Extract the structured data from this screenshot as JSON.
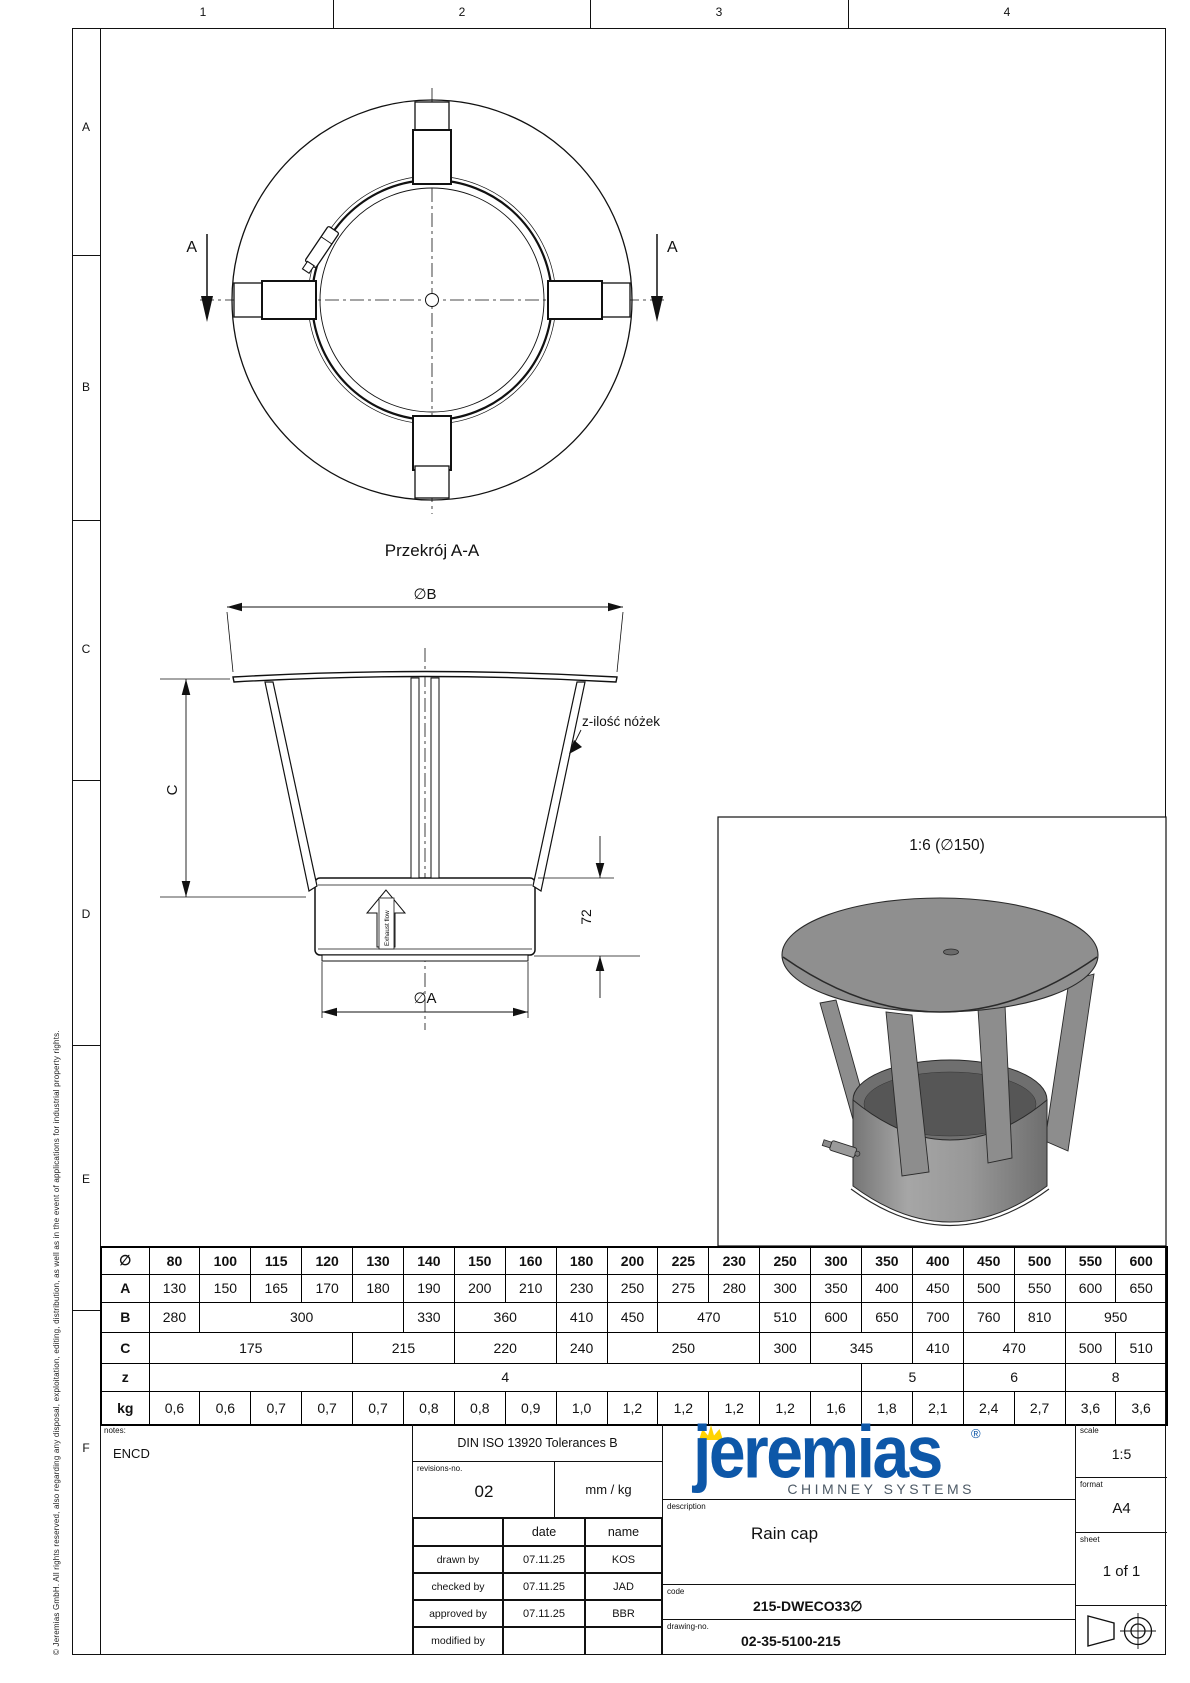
{
  "rulers": {
    "top": [
      "1",
      "2",
      "3",
      "4"
    ],
    "left": [
      "A",
      "B",
      "C",
      "D",
      "E",
      "F"
    ]
  },
  "copyright": "© Jeremias GmbH. All rights reserved, also regarding any disposal, exploitation, editing, distribution, as well as in the event of applications for industrial property rights.",
  "views": {
    "section_label": "Przekrój A-A",
    "marker": "A",
    "dim_b": "∅B",
    "dim_a": "∅A",
    "dim_c": "C",
    "dim_72": "72",
    "legs_label": "z-ilość nóżek",
    "exhaust": "Exhaust flow",
    "detail_label": "1:6 (∅150)"
  },
  "table": {
    "corner": "∅",
    "sizes": [
      "80",
      "100",
      "115",
      "120",
      "130",
      "140",
      "150",
      "160",
      "180",
      "200",
      "225",
      "230",
      "250",
      "300",
      "350",
      "400",
      "450",
      "500",
      "550",
      "600"
    ],
    "rows": [
      {
        "label": "A",
        "cells": [
          [
            "130",
            1
          ],
          [
            "150",
            1
          ],
          [
            "165",
            1
          ],
          [
            "170",
            1
          ],
          [
            "180",
            1
          ],
          [
            "190",
            1
          ],
          [
            "200",
            1
          ],
          [
            "210",
            1
          ],
          [
            "230",
            1
          ],
          [
            "250",
            1
          ],
          [
            "275",
            1
          ],
          [
            "280",
            1
          ],
          [
            "300",
            1
          ],
          [
            "350",
            1
          ],
          [
            "400",
            1
          ],
          [
            "450",
            1
          ],
          [
            "500",
            1
          ],
          [
            "550",
            1
          ],
          [
            "600",
            1
          ],
          [
            "650",
            1
          ]
        ]
      },
      {
        "label": "B",
        "cells": [
          [
            "280",
            1
          ],
          [
            "300",
            4
          ],
          [
            "330",
            1
          ],
          [
            "360",
            2
          ],
          [
            "410",
            1
          ],
          [
            "450",
            1
          ],
          [
            "470",
            2
          ],
          [
            "510",
            1
          ],
          [
            "600",
            1
          ],
          [
            "650",
            1
          ],
          [
            "700",
            1
          ],
          [
            "760",
            1
          ],
          [
            "810",
            1
          ],
          [
            "950",
            2
          ]
        ]
      },
      {
        "label": "C",
        "cells": [
          [
            "175",
            4
          ],
          [
            "215",
            2
          ],
          [
            "220",
            2
          ],
          [
            "240",
            1
          ],
          [
            "250",
            3
          ],
          [
            "300",
            1
          ],
          [
            "345",
            2
          ],
          [
            "410",
            1
          ],
          [
            "470",
            2
          ],
          [
            "500",
            1
          ],
          [
            "510",
            1
          ]
        ]
      },
      {
        "label": "z",
        "cells": [
          [
            "4",
            14
          ],
          [
            "5",
            2
          ],
          [
            "6",
            2
          ],
          [
            "8",
            2
          ]
        ]
      },
      {
        "label": "kg",
        "cells": [
          [
            "0,6",
            1
          ],
          [
            "0,6",
            1
          ],
          [
            "0,7",
            1
          ],
          [
            "0,7",
            1
          ],
          [
            "0,7",
            1
          ],
          [
            "0,8",
            1
          ],
          [
            "0,8",
            1
          ],
          [
            "0,9",
            1
          ],
          [
            "1,0",
            1
          ],
          [
            "1,2",
            1
          ],
          [
            "1,2",
            1
          ],
          [
            "1,2",
            1
          ],
          [
            "1,2",
            1
          ],
          [
            "1,6",
            1
          ],
          [
            "1,8",
            1
          ],
          [
            "2,1",
            1
          ],
          [
            "2,4",
            1
          ],
          [
            "2,7",
            1
          ],
          [
            "3,6",
            1
          ],
          [
            "3,6",
            1
          ]
        ]
      }
    ]
  },
  "title_block": {
    "notes_label": "notes:",
    "notes_value": "ENCD",
    "tolerances": "DIN ISO 13920 Tolerances B",
    "revisions_label": "revisions-no.",
    "revisions_value": "02",
    "units": "mm / kg",
    "col_date": "date",
    "col_name": "name",
    "rows": [
      [
        "drawn by",
        "07.11.25",
        "KOS"
      ],
      [
        "checked by",
        "07.11.25",
        "JAD"
      ],
      [
        "approved by",
        "07.11.25",
        "BBR"
      ],
      [
        "modified by",
        "",
        ""
      ]
    ],
    "logo_text": "jeremias",
    "logo_reg": "®",
    "logo_sub": "CHIMNEY SYSTEMS",
    "description_label": "description",
    "description": "Rain cap",
    "code_label": "code",
    "code": "215-DWECO33∅",
    "drawing_no_label": "drawing-no.",
    "drawing_no": "02-35-5100-215",
    "scale_label": "scale",
    "scale": "1:5",
    "format_label": "format",
    "format": "A4",
    "sheet_label": "sheet",
    "sheet": "1 of 1",
    "colors": {
      "brand_blue": "#0d57a8",
      "crown_yellow": "#ffd300",
      "logo_gray": "#4d5a66"
    }
  }
}
